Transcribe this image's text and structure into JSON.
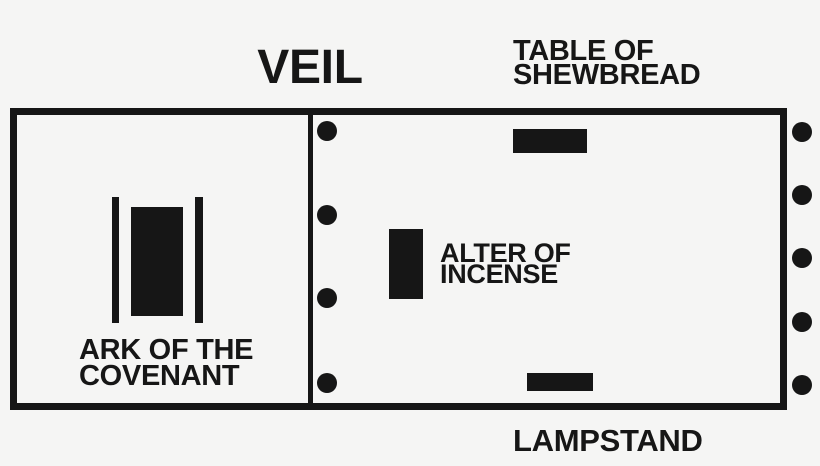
{
  "diagram": {
    "name": "Tabernacle floor plan",
    "labels": {
      "veil": "VEIL",
      "table_of_shewbread": {
        "line1": "TABLE OF",
        "line2": "SHEWBREAD"
      },
      "alter_of_incense": {
        "line1": "ALTER OF",
        "line2": "INCENSE"
      },
      "ark_of_the_covenant": {
        "line1": "ARK OF THE",
        "line2": "COVENANT"
      },
      "lampstand": "LAMPSTAND"
    },
    "pillar_dots": {
      "veil_dot_count": 4,
      "right_wall_dot_count": 5
    },
    "colors": {
      "ink": "#161616",
      "background": "#f5f5f4"
    }
  }
}
